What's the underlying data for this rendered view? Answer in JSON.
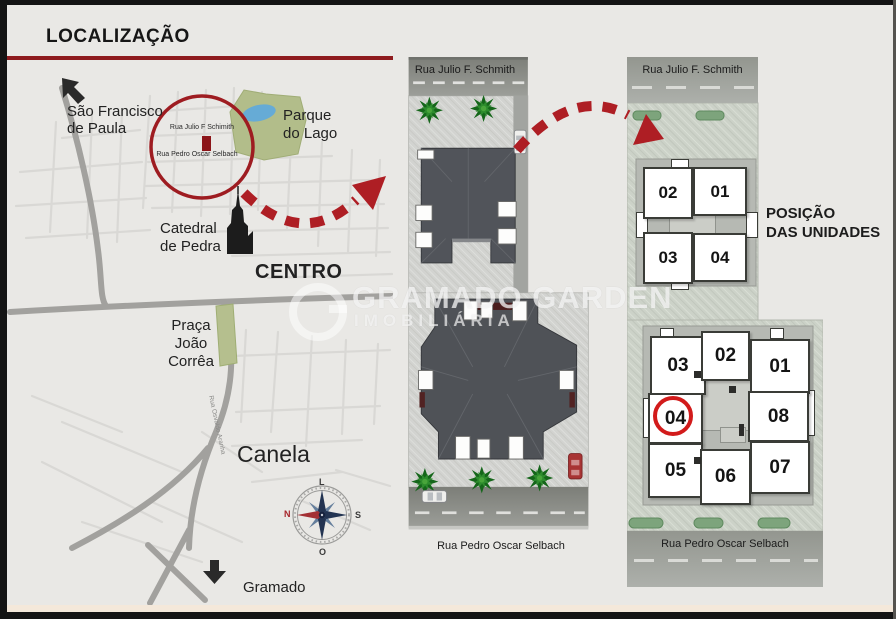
{
  "header": {
    "title": "LOCALIZAÇÃO"
  },
  "watermark": {
    "name": "GRAMADO GARDEN",
    "tagline": "IMOBILIÁRIA"
  },
  "map": {
    "places": {
      "sao_francisco_l1": "São Francisco",
      "sao_francisco_l2": "de Paula",
      "parque_l1": "Parque",
      "parque_l2": "do Lago",
      "catedral_l1": "Catedral",
      "catedral_l2": "de Pedra",
      "centro": "CENTRO",
      "praca_l1": "Praça",
      "praca_l2": "João Corrêa",
      "canela": "Canela",
      "gramado": "Gramado"
    },
    "streets": {
      "julio_schimith": "Rua Julio F Schimith",
      "pedro_selbach": "Rua Pedro Oscar Selbach",
      "osvaldo_aranha": "Rua Osvaldo Aranha"
    },
    "compass": {
      "top": "L",
      "left": "N",
      "right": "S",
      "bottom": "O"
    }
  },
  "site_plan": {
    "street_top": "Rua Julio F. Schmith",
    "street_bottom": "Rua Pedro Oscar Selbach"
  },
  "units_panel": {
    "street_top": "Rua Julio F. Schmith",
    "street_bottom": "Rua Pedro Oscar Selbach",
    "caption_l1": "POSIÇÃO",
    "caption_l2": "DAS UNIDADES",
    "floor_top": {
      "u1": "02",
      "u2": "01",
      "u3": "03",
      "u4": "04"
    },
    "floor_bottom": {
      "u1": "03",
      "u2": "02",
      "u3": "01",
      "u4": "04",
      "u5": "08",
      "u6": "05",
      "u7": "06",
      "u8": "07"
    },
    "highlighted_unit": "04"
  },
  "colors": {
    "accent_red": "#ae1e24",
    "title_line_red": "#8e1b1e"
  }
}
